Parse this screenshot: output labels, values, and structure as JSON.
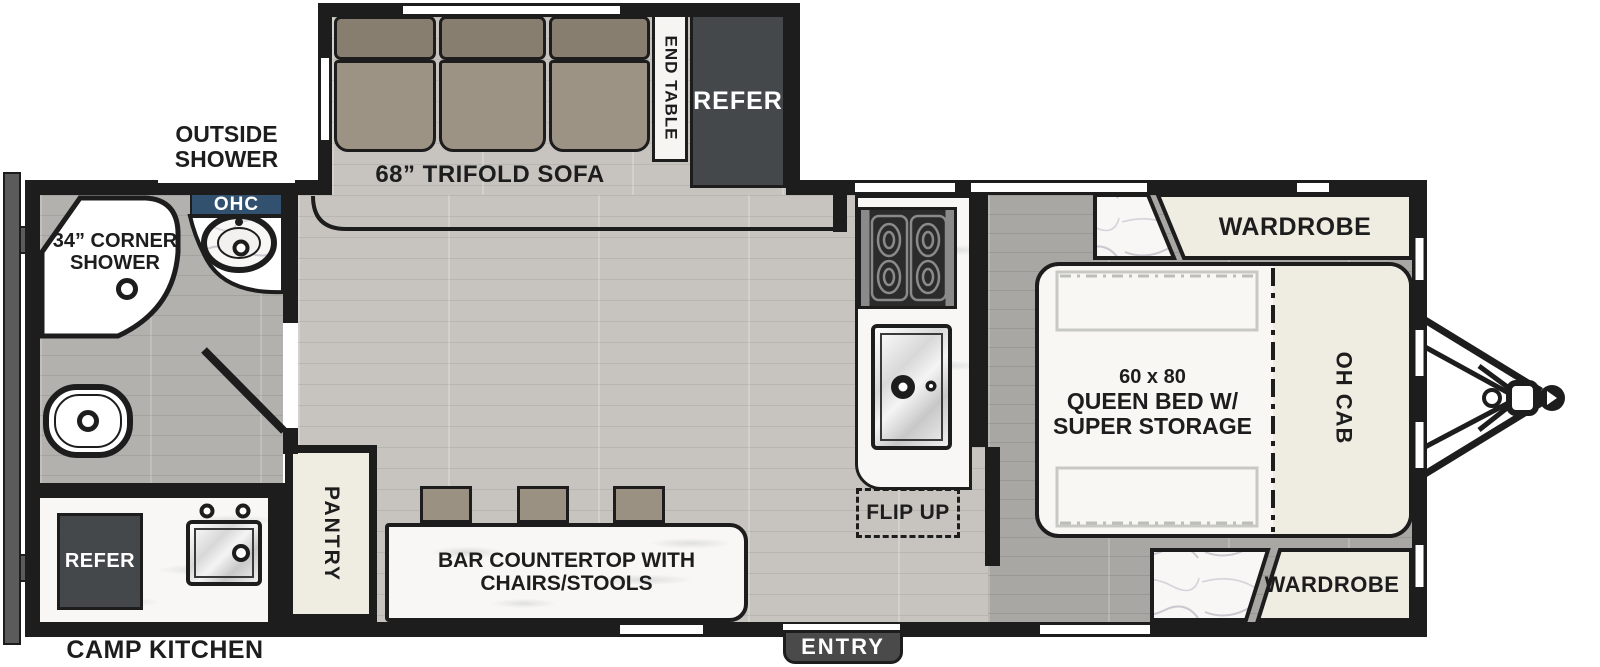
{
  "colors": {
    "wall": "#1d1d1d",
    "ohc_bg": "#31516f",
    "entry_bg": "#4a4a4a",
    "refer_bg": "#45484b",
    "sofa_back": "#877e70",
    "sofa_seat": "#9d9384",
    "stool": "#9a9183",
    "cabinet_cream": "#efece2",
    "floor_main": "#c7c4bf",
    "floor_bedroom": "#a9a7a3",
    "floor_bath": "#b3b1ad",
    "bumper": "#5b5b5b"
  },
  "living": {
    "sofa_label": "68” TRIFOLD SOFA",
    "end_table_label": "END TABLE",
    "refer_label": "REFER"
  },
  "bathroom": {
    "outside_shower_line1": "OUTSIDE",
    "outside_shower_line2": "SHOWER",
    "corner_shower_line1": "34” CORNER",
    "corner_shower_line2": "SHOWER",
    "ohc_label": "OHC"
  },
  "kitchen": {
    "flip_up_label": "FLIP UP",
    "pantry_label": "PANTRY",
    "bar_line1": "BAR COUNTERTOP WITH",
    "bar_line2": "CHAIRS/STOOLS"
  },
  "camp_kitchen": {
    "refer_label": "REFER",
    "label": "CAMP KITCHEN"
  },
  "bedroom": {
    "bed_line1": "60 x 80",
    "bed_line2": "QUEEN BED W/",
    "bed_line3": "SUPER STORAGE",
    "oh_cab_label": "OH CAB",
    "wardrobe_top_label": "WARDROBE",
    "wardrobe_bottom_label": "WARDROBE"
  },
  "entry": {
    "label": "ENTRY"
  }
}
